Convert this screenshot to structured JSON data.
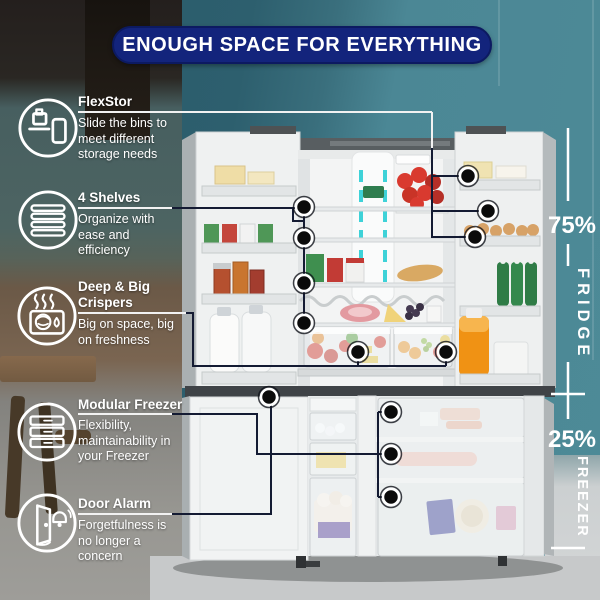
{
  "header": {
    "title": "ENOUGH SPACE FOR EVERYTHING"
  },
  "features": [
    {
      "title": "FlexStor",
      "description": "Slide the bins to meet different storage needs",
      "icon": "flexstor-bins-icon"
    },
    {
      "title": "4 Shelves",
      "description": "Organize with ease and efficiency",
      "icon": "four-shelves-icon"
    },
    {
      "title": "Deep & Big Crispers",
      "description": "Big on space, big on freshness",
      "icon": "crisper-steam-icon"
    },
    {
      "title": "Modular Freezer",
      "description": "Flexibility, maintainability in your Freezer",
      "icon": "freezer-drawers-icon"
    },
    {
      "title": "Door Alarm",
      "description": "Forgetfulness is no longer a concern",
      "icon": "door-alarm-bell-icon"
    }
  ],
  "capacity": {
    "fridge": {
      "percent": "75%",
      "label": "FRIDGE"
    },
    "freezer": {
      "percent": "25%",
      "label": "FREEZER"
    }
  },
  "colors": {
    "header_bg": "#13247c",
    "wall_teal": "#48828f",
    "line_dark": "#141b33",
    "line_light": "#f2f2f2",
    "accent_cyan": "#3ed2d8",
    "dot_black": "#0b0b0b"
  }
}
